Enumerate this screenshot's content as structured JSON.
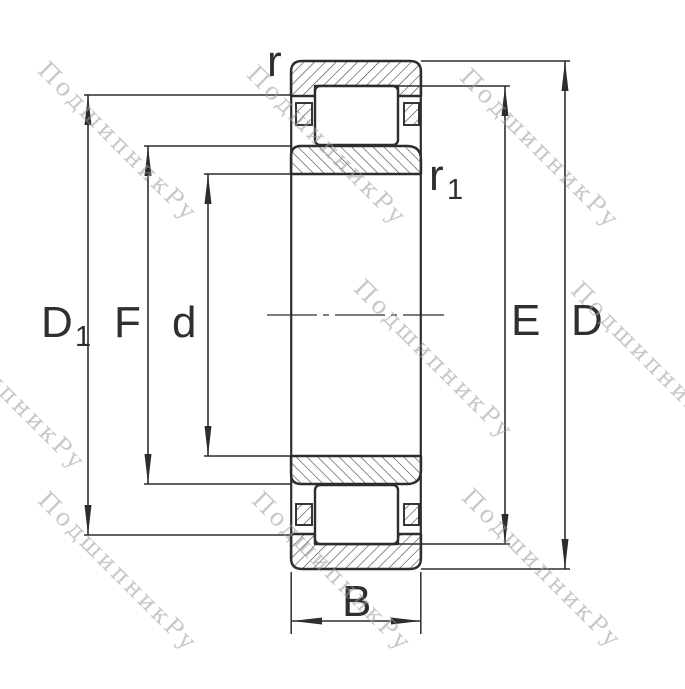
{
  "watermark": {
    "text": "ПодшипникРу"
  },
  "drawing": {
    "title": "cylindrical-roller-bearing-cross-section",
    "labels": {
      "r": "r",
      "r1": {
        "base": "r",
        "sub": "1"
      },
      "D1": {
        "base": "D",
        "sub": "1"
      },
      "F": "F",
      "d": "d",
      "E": "E",
      "D": "D",
      "B": "B"
    },
    "colors": {
      "line": "#2d2d2d",
      "hatch": "#3a3a3a",
      "label": "#2f2f2f",
      "watermark": "#b9b9b9",
      "background": "#ffffff"
    }
  }
}
